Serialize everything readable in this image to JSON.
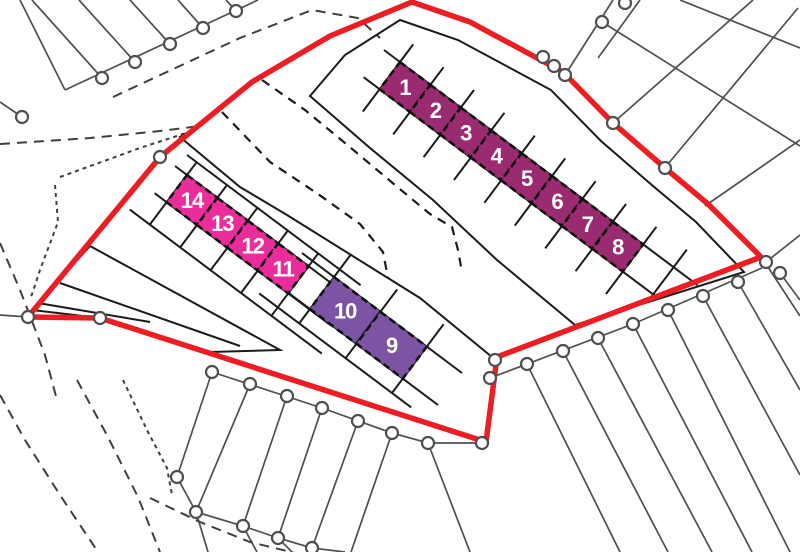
{
  "colors": {
    "site_boundary": "#ee1c23",
    "road_fill": "#fcf6b5",
    "plots_1_8_fill": "#9b2b70",
    "plots_9_10_fill": "#7b55a4",
    "plots_11_14_fill": "#ea2d9b"
  },
  "plots": {
    "group_1_8": [
      "1",
      "2",
      "3",
      "4",
      "5",
      "6",
      "7",
      "8"
    ],
    "group_9_10": [
      "10",
      "9"
    ],
    "group_11_14": [
      "14",
      "13",
      "12",
      "11"
    ]
  }
}
